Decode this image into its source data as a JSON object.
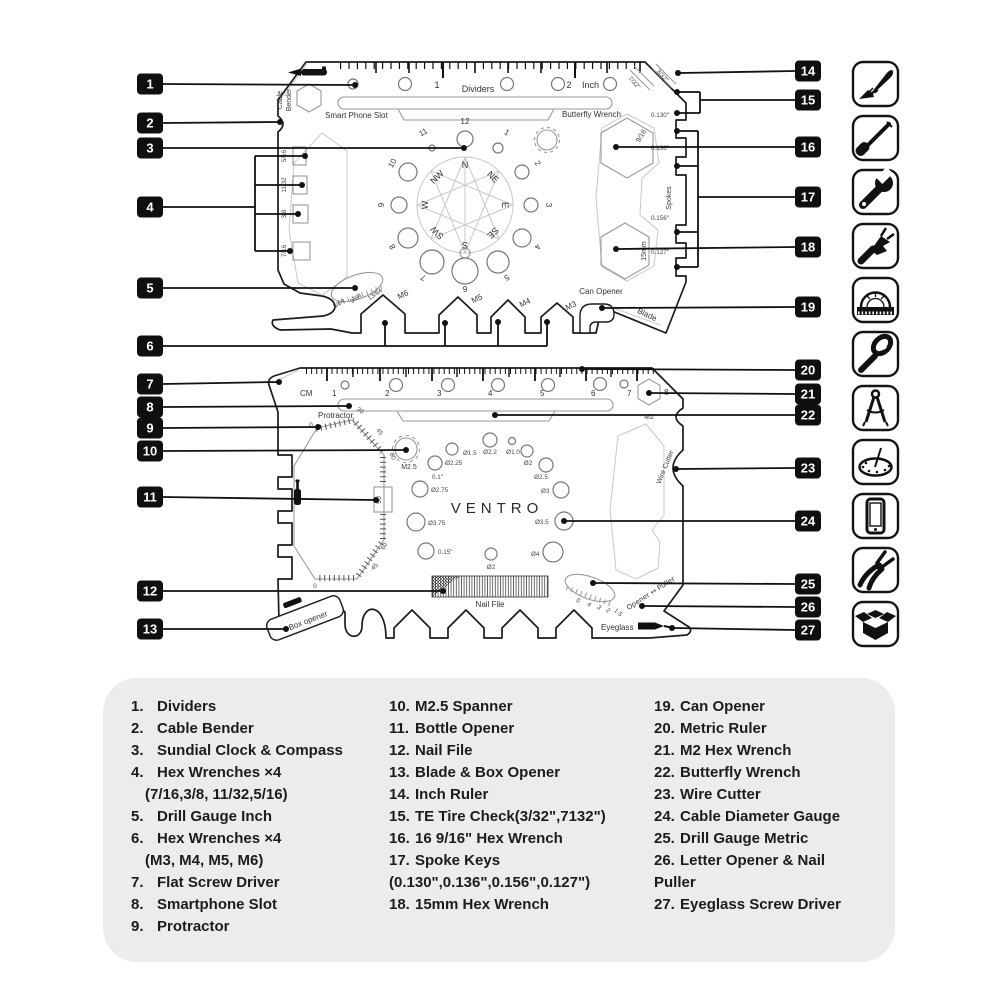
{
  "markers": [
    "1",
    "2",
    "3",
    "4",
    "5",
    "6",
    "7",
    "8",
    "9",
    "10",
    "11",
    "12",
    "13",
    "14",
    "15",
    "16",
    "17",
    "18",
    "19",
    "20",
    "21",
    "22",
    "23",
    "24",
    "25",
    "26",
    "27"
  ],
  "card1": {
    "ruler": {
      "one": "1",
      "two": "2",
      "unit": "Inch",
      "dividers": "Dividers"
    },
    "slot_left": "Smart Phone Slot",
    "slot_right": "Butterfly Wrench",
    "cable1": "Cable",
    "cable2": "Bender",
    "hex_left": [
      "5/16",
      "11/32",
      "3/8",
      "7/16"
    ],
    "gauge": [
      "5/64",
      "9/64",
      "13/64"
    ],
    "clock": [
      "12",
      "1",
      "2",
      "3",
      "4",
      "5",
      "6",
      "7",
      "8",
      "9",
      "10",
      "11"
    ],
    "compass": [
      "N",
      "NE",
      "E",
      "SE",
      "S",
      "SW",
      "W",
      "NW"
    ],
    "hex_bottom": [
      "M6",
      "M5",
      "M4",
      "M3"
    ],
    "can": "Can Opener",
    "blade": "Blade",
    "tire": [
      "7/32\"",
      "3/32\""
    ],
    "spoke_sizes": [
      "0.130\"",
      "0.136\"",
      "0.156\"",
      "0.127\""
    ],
    "spokes": "Spokes",
    "hex916": "9/16",
    "hex15": "15mm"
  },
  "card2": {
    "unit": "CM",
    "nums": [
      "1",
      "2",
      "3",
      "4",
      "5",
      "6",
      "7",
      "8"
    ],
    "protractor": "Protractor",
    "deg": [
      "0",
      "30",
      "45",
      "60",
      "90",
      "60",
      "45",
      "0"
    ],
    "m25": "M2.5",
    "m2": "M2",
    "logo": "VENTRO",
    "dia": [
      "Ø1.5",
      "Ø2.2",
      "Ø1.0",
      "Ø2",
      "Ø2.25",
      "Ø2.5",
      "0.1\"",
      "Ø2.75",
      "Ø3",
      "Ø3.75",
      "Ø3.5",
      "0.15\"",
      "Ø2",
      "Ø4"
    ],
    "wire": "Wire Cutter",
    "nail": "Nail File",
    "box": "Box opener",
    "opener": "Opener ↔ Puller",
    "eyeglass": "Eyeglass",
    "gauge": [
      "5",
      "4",
      "3",
      "2",
      "1.5"
    ]
  },
  "icons": [
    "knife",
    "screwdriver",
    "wrench",
    "can-opener",
    "protractor",
    "bottle-opener",
    "dividers-compass",
    "sundial-clock",
    "smartphone",
    "pliers",
    "open-box"
  ],
  "legend": {
    "col1": [
      {
        "n": "1.",
        "t": "Dividers"
      },
      {
        "n": "2.",
        "t": "Cable Bender"
      },
      {
        "n": "3.",
        "t": "Sundial Clock & Compass"
      },
      {
        "n": "4.",
        "t": "Hex Wrenches ×4"
      },
      {
        "n": "",
        "t": "(7/16,3/8, 11/32,5/16)"
      },
      {
        "n": "5.",
        "t": "Drill Gauge Inch"
      },
      {
        "n": "6.",
        "t": "Hex Wrenches ×4"
      },
      {
        "n": "",
        "t": "(M3, M4, M5, M6)"
      },
      {
        "n": "7.",
        "t": "Flat Screw Driver"
      },
      {
        "n": "8.",
        "t": "Smartphone Slot"
      },
      {
        "n": "9.",
        "t": "Protractor"
      }
    ],
    "col2": [
      {
        "n": "10.",
        "t": "M2.5 Spanner"
      },
      {
        "n": "11.",
        "t": "Bottle Opener"
      },
      {
        "n": "12.",
        "t": "Nail File"
      },
      {
        "n": "13.",
        "t": "Blade & Box Opener"
      },
      {
        "n": "14.",
        "t": "Inch Ruler"
      },
      {
        "n": "15.",
        "t": "TE Tire Check(3/32\",7132\")"
      },
      {
        "n": "16.",
        "t": "16 9/16\" Hex Wrench"
      },
      {
        "n": "17.",
        "t": "Spoke Keys"
      },
      {
        "n": "",
        "t": "(0.130\",0.136\",0.156\",0.127\")"
      },
      {
        "n": "18.",
        "t": "15mm Hex Wrench"
      }
    ],
    "col3": [
      {
        "n": "19.",
        "t": "Can Opener"
      },
      {
        "n": "20.",
        "t": "Metric Ruler"
      },
      {
        "n": "21.",
        "t": "M2 Hex Wrench"
      },
      {
        "n": "22.",
        "t": "Butterfly Wrench"
      },
      {
        "n": "23.",
        "t": "Wire Cutter"
      },
      {
        "n": "24.",
        "t": "Cable Diameter Gauge"
      },
      {
        "n": "25.",
        "t": "Drill Gauge Metric"
      },
      {
        "n": "26.",
        "t": "Letter Opener & Nail"
      },
      {
        "n": "",
        "t": "Puller"
      },
      {
        "n": "27.",
        "t": "Eyeglass Screw Driver"
      }
    ]
  }
}
